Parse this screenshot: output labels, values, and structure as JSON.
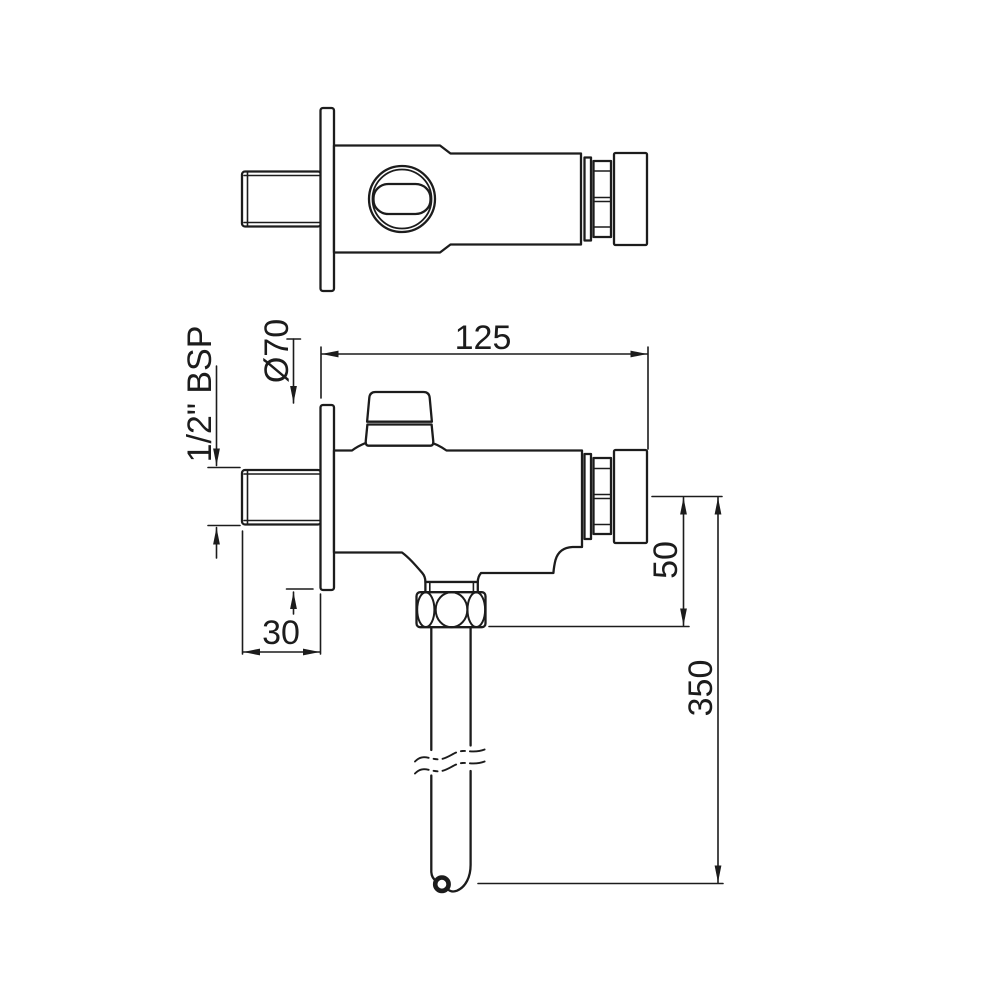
{
  "drawing": {
    "background_color": "#ffffff",
    "line_color": "#1c1c1c",
    "dimension_labels": {
      "overall_length": "125",
      "flange_diameter": "Ø70",
      "inlet_thread_size": "1/2\" BSP",
      "inlet_projection": "30",
      "axis_to_outlet": "50",
      "outlet_pipe_length": "350"
    }
  }
}
